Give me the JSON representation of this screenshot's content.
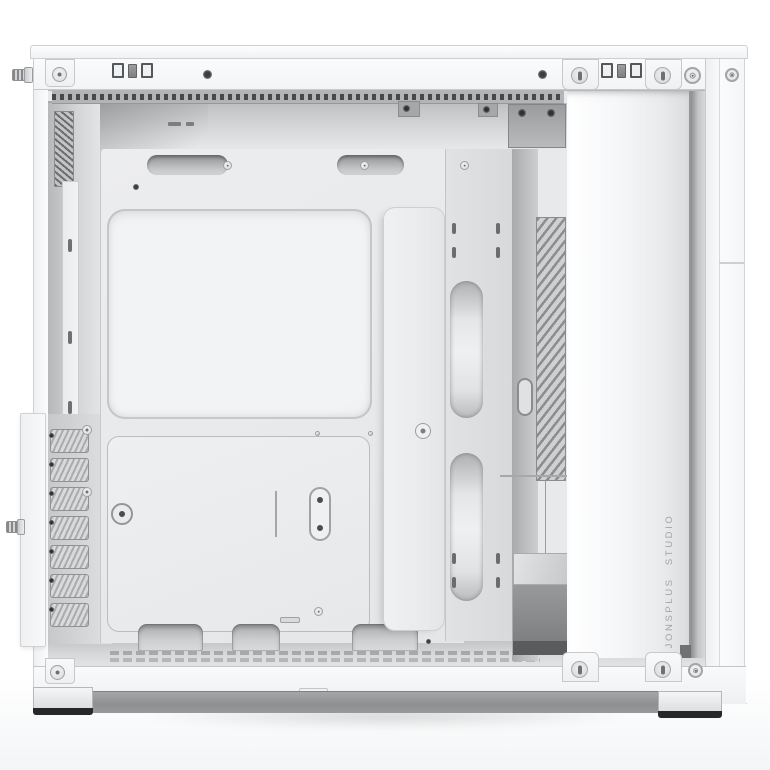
{
  "scene": {
    "subject": "White tower PC case photographed from the open left side, side panel removed, empty interior exposed",
    "branding": {
      "front_panel_text": "JONSPLUS STUDIO"
    },
    "counts": {
      "expansion_slot_covers": 7,
      "top_cable_grommets": 2,
      "bottom_cable_cutouts": 3,
      "front_mount_tabs_top": 2,
      "front_mount_tabs_bottom": 2
    },
    "colors": {
      "background": "#ffffff",
      "case_shell": "#f8f9fa",
      "interior_panel": "#e8eaec",
      "recess_shadow": "#b4b6b8",
      "vent_dark": "#55585a",
      "skirt": "#919395",
      "foot_base": "#26282a",
      "brand_text": "#a2a5a9"
    }
  }
}
